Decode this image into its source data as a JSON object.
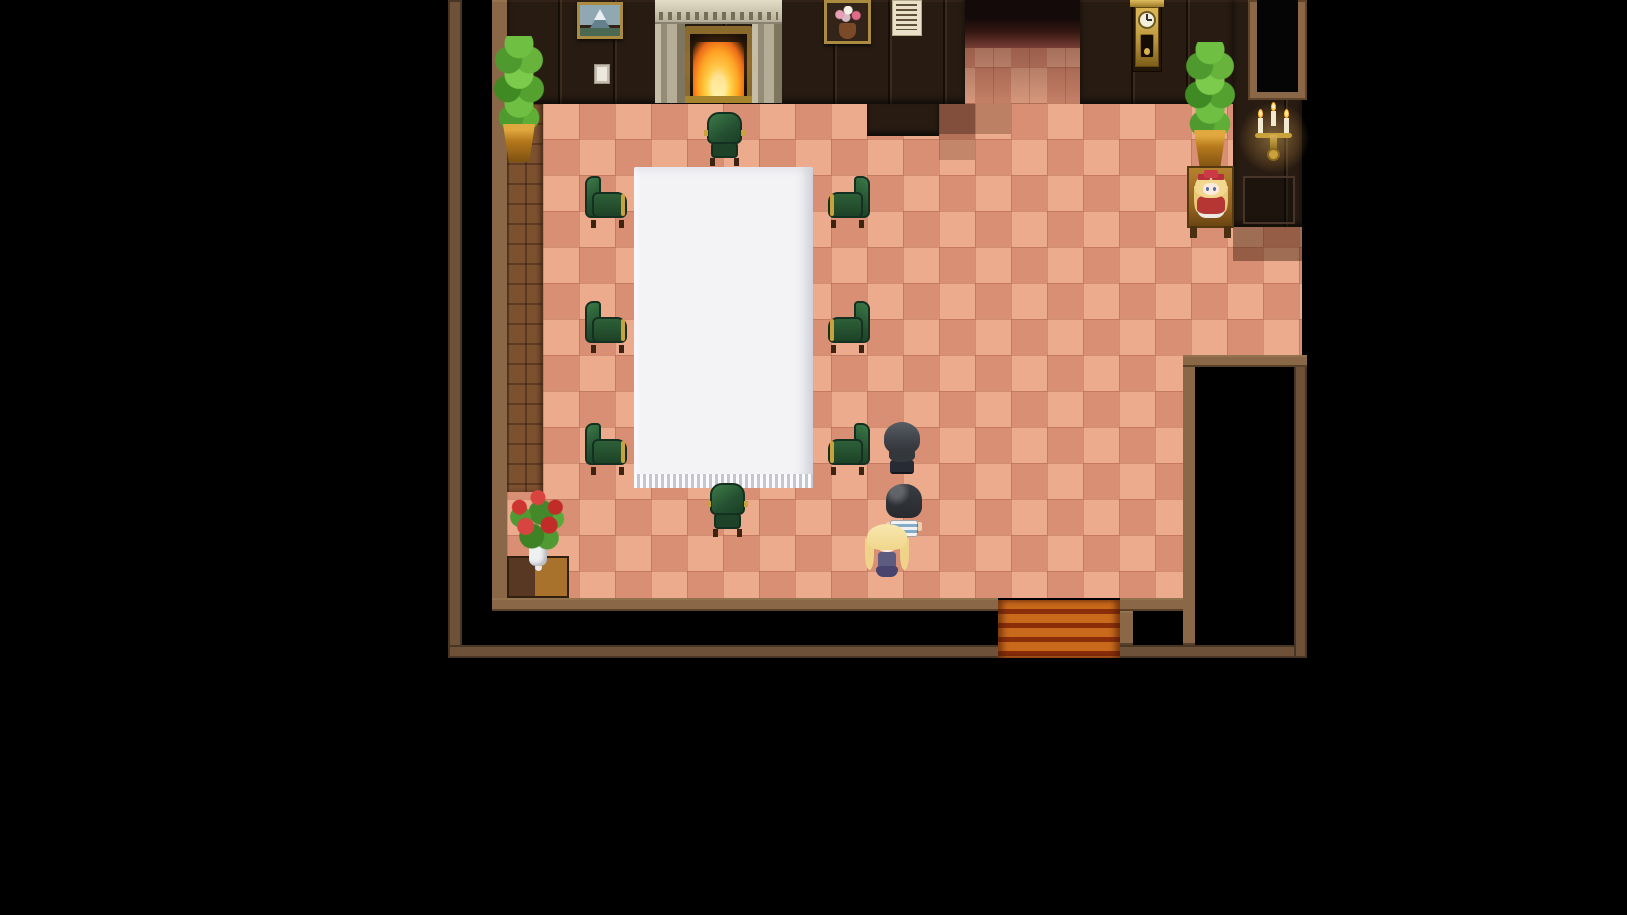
{
  "scene": {
    "title": "top-down-rpg-room-interior",
    "type": "game-screenshot",
    "visible_text": [],
    "room": {
      "floor": "salmon checkerboard tiles, 36px grid",
      "exits": [
        "stairs-south",
        "corridor-north",
        "doorway-northeast"
      ],
      "decor": [
        "painting-mountain",
        "light-switch",
        "fireplace-with-fire",
        "painting-flowers",
        "wall-poster",
        "grandfather-clock",
        "wall-candelabra",
        "doorway-top-right",
        "potted-plant-left",
        "potted-plant-right",
        "doll-on-table",
        "rose-bouquet-stand",
        "white-banquet-table",
        "green-armchairs"
      ]
    }
  },
  "palette": {
    "tile-light": "#ecab8d",
    "tile-mid": "#d98f74",
    "wall-dark": "#271b12",
    "wall-brown": "#8a6847",
    "border-outer": "#6d5138",
    "wood-column": "#7c5130",
    "table-white": "#f3f3f6",
    "gold": "#c9a23c",
    "stairs-orange": "#c9691c",
    "stairs-stripe": "#8a2e0a"
  },
  "sprites": {
    "chairs": [
      {
        "variant": "side-left",
        "x": 583,
        "y": 176
      },
      {
        "variant": "side-left",
        "x": 583,
        "y": 301
      },
      {
        "variant": "side-left",
        "x": 583,
        "y": 423
      },
      {
        "variant": "side-right",
        "x": 826,
        "y": 176
      },
      {
        "variant": "side-right",
        "x": 826,
        "y": 301
      },
      {
        "variant": "side-right",
        "x": 826,
        "y": 423
      },
      {
        "variant": "vert",
        "x": 703,
        "y": 110
      },
      {
        "variant": "vert",
        "x": 706,
        "y": 481
      }
    ],
    "characters": [
      {
        "id": "npc-dark-suit",
        "x": 882,
        "y": 422,
        "hair": "#43474c",
        "outfit": "#272b34"
      },
      {
        "id": "npc-striped-shirt",
        "x": 884,
        "y": 484,
        "hair": "#2f3237",
        "outfit": "white-blue-stripes"
      },
      {
        "id": "girl-blonde",
        "x": 864,
        "y": 524,
        "hair": "#f4dc9a",
        "outfit": "#5e5b80"
      }
    ]
  }
}
